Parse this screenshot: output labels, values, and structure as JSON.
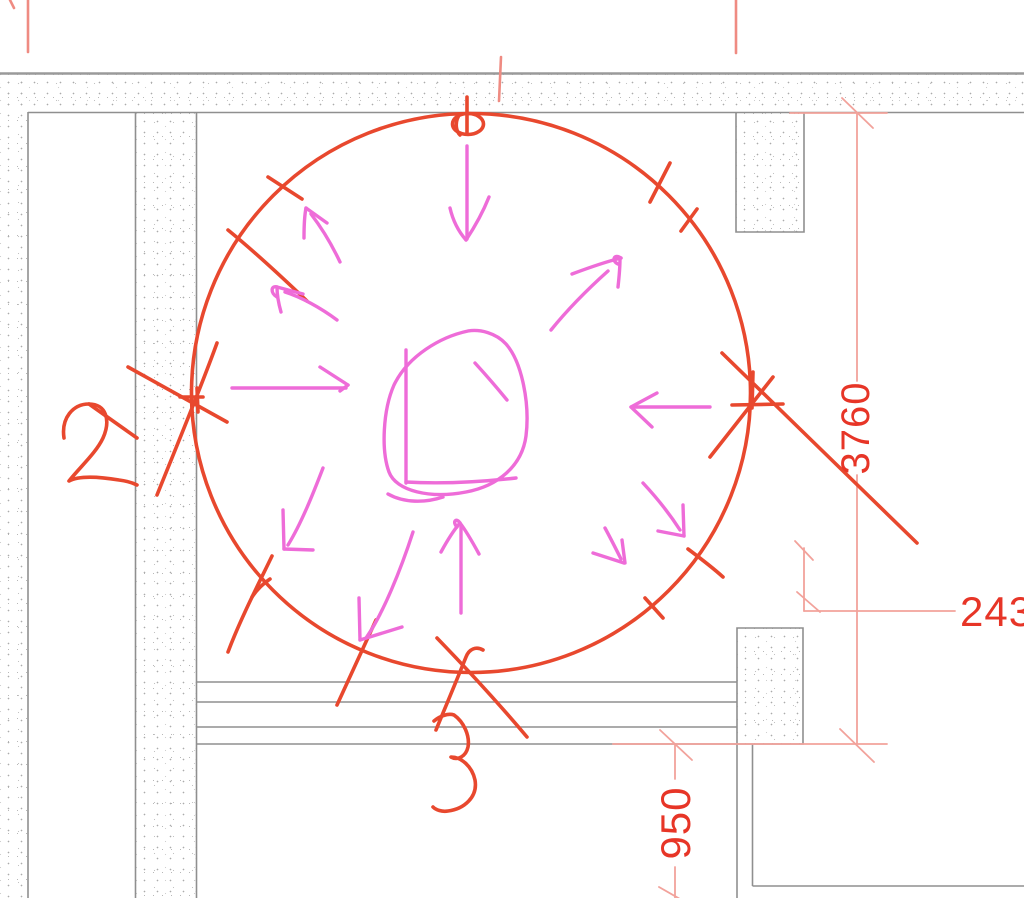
{
  "dimensions": {
    "top_partial": "1240",
    "vertical_right": "3760",
    "horizontal_right": "243",
    "vertical_bottom": "950"
  },
  "sketch_labels": {
    "left_number": "2",
    "bottom_number": "3"
  },
  "colors": {
    "sketch_red": "#e8482e",
    "sketch_pink": "#ee6cd8",
    "dimension_line": "#f2a29b",
    "dimension_tick_strong": "#ef8b82",
    "dimension_text": "#e73527",
    "cad_line": "#8f8f8f",
    "wall_hatch_dot": "#b5b5b5"
  }
}
